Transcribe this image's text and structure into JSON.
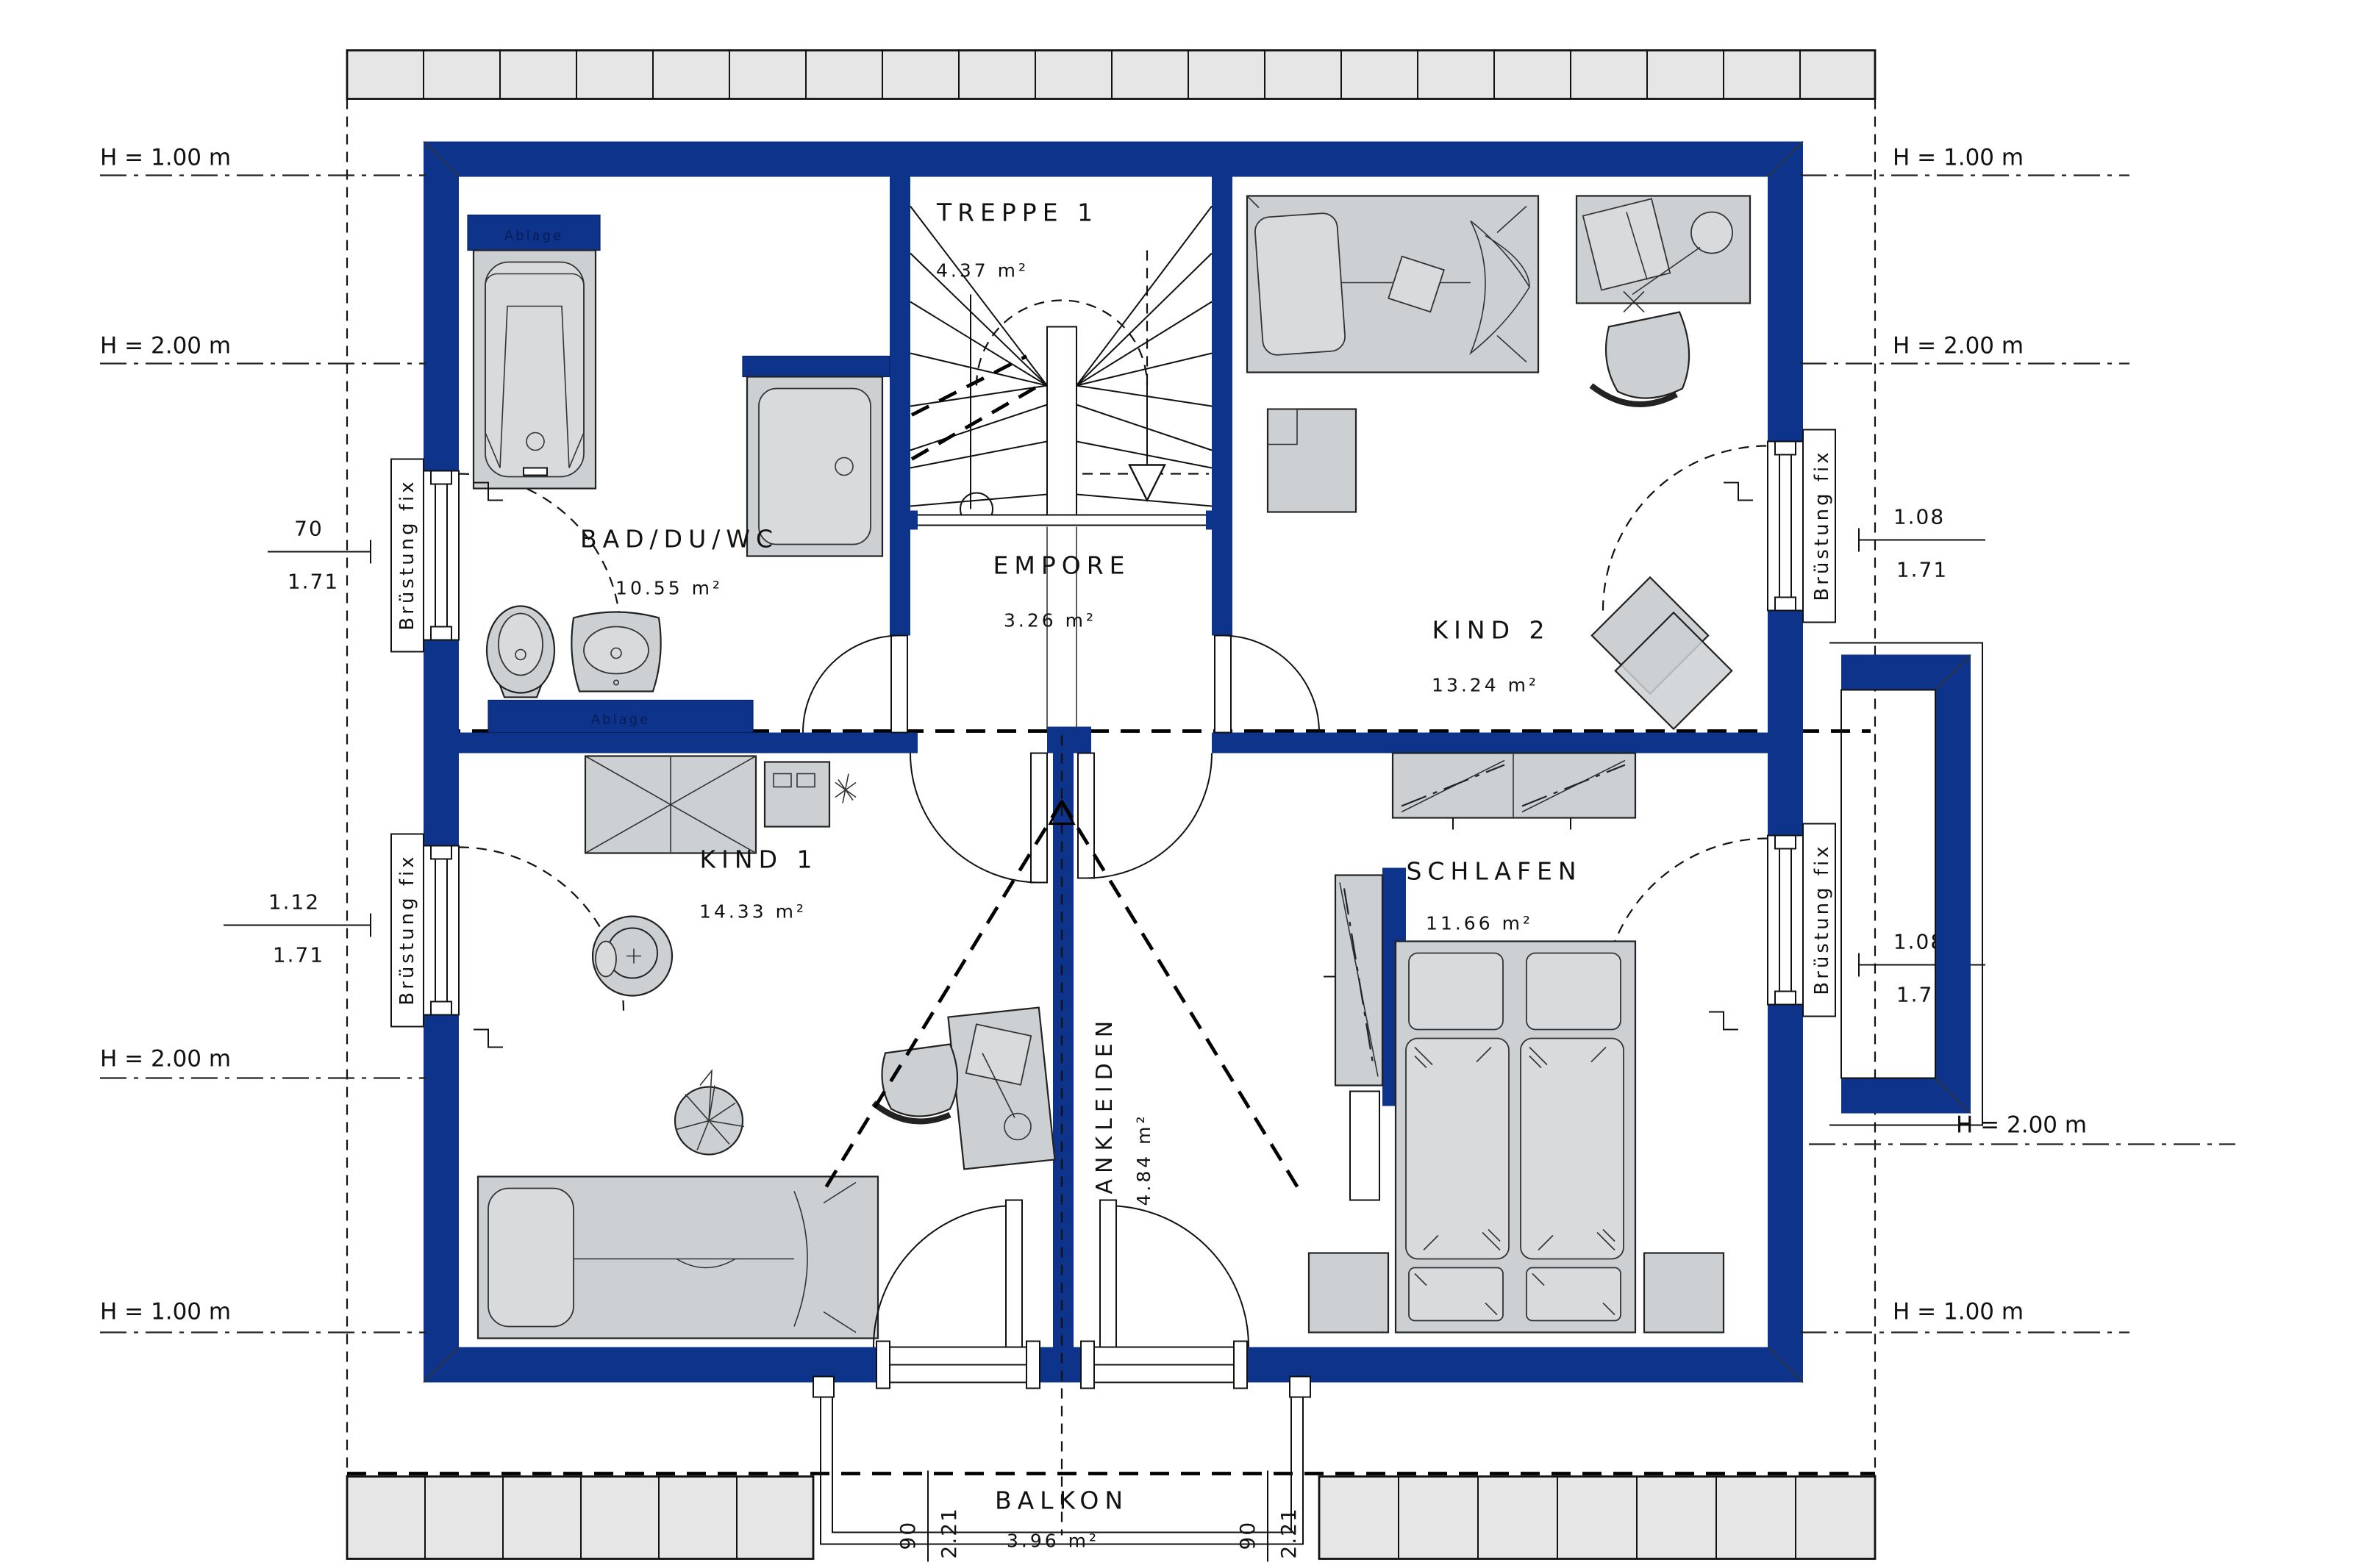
{
  "plan": {
    "rooms": {
      "treppe": {
        "name": "TREPPE 1",
        "area": "4.37 m²"
      },
      "empore": {
        "name": "EMPORE",
        "area": "3.26 m²"
      },
      "bad": {
        "name": "BAD/DU/WC",
        "area": "10.55 m²"
      },
      "kind2": {
        "name": "KIND 2",
        "area": "13.24 m²"
      },
      "kind1": {
        "name": "KIND 1",
        "area": "14.33 m²"
      },
      "schlafen": {
        "name": "SCHLAFEN",
        "area": "11.66 m²"
      },
      "ankleiden": {
        "name": "ANKLEIDEN",
        "area": "4.84 m²"
      },
      "balkon": {
        "name": "BALKON",
        "area": "3.96 m²"
      }
    },
    "height_lines": {
      "h100": "H = 1.00 m",
      "h200": "H = 2.00 m"
    },
    "parapet_label": "Brüstung fix",
    "shelf_label": "Ablage",
    "window_dims": {
      "bad": {
        "width": "70",
        "height": "1.71"
      },
      "kind1": {
        "width": "1.12",
        "height": "1.71"
      },
      "kind2": {
        "width": "1.08",
        "height": "1.71"
      },
      "schlafen": {
        "width": "1.08",
        "height": "1.71"
      }
    },
    "balcony_door_dims": {
      "width": "90",
      "height": "2.21"
    },
    "colors": {
      "wall": "#0d338a",
      "furniture": "#cdd0d2",
      "eave": "#e6e6e6"
    }
  }
}
